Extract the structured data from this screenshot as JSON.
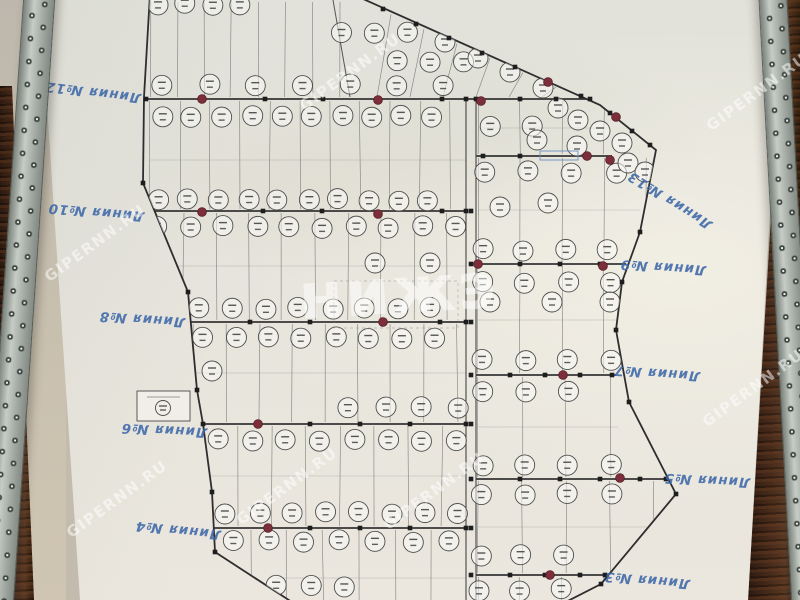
{
  "watermarks": {
    "site_text": "GIPERNN.RU",
    "logo_text": "нижэ"
  },
  "map": {
    "line_labels": [
      {
        "id": "12",
        "text": "Линия №12"
      },
      {
        "id": "10",
        "text": "Линия №10"
      },
      {
        "id": "8",
        "text": "Линия №8"
      },
      {
        "id": "6",
        "text": "Линия №6"
      },
      {
        "id": "4",
        "text": "Линия №4"
      },
      {
        "id": "13",
        "text": "Линия №13"
      },
      {
        "id": "9",
        "text": "Линия №9"
      },
      {
        "id": "7",
        "text": "Линия №7"
      },
      {
        "id": "5",
        "text": "Линия №5"
      },
      {
        "id": "3",
        "text": "Линия №3"
      }
    ]
  }
}
